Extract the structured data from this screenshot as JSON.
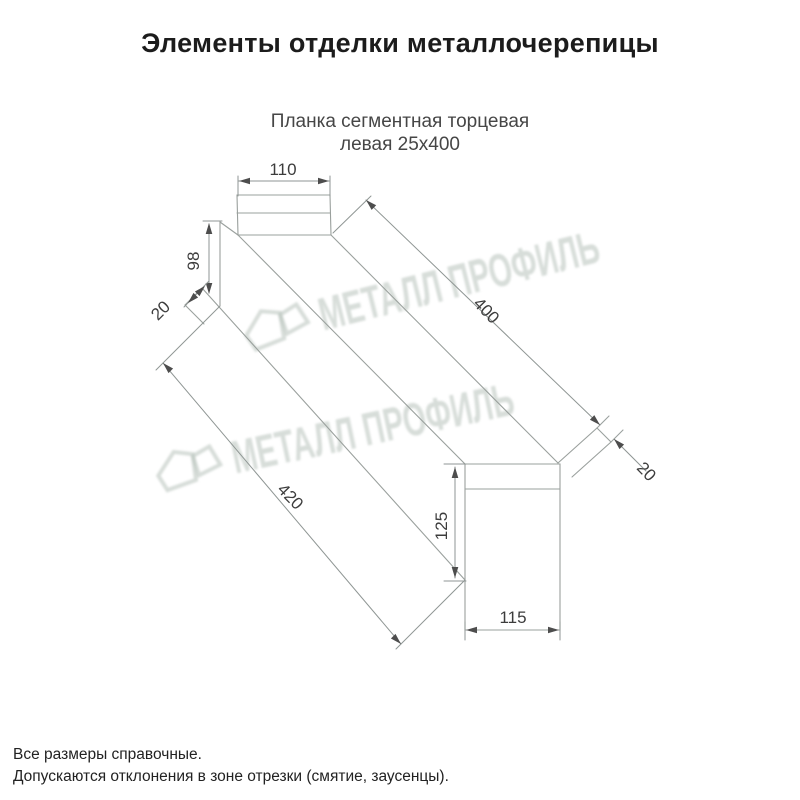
{
  "header": {
    "title": "Элементы отделки металлочерепицы"
  },
  "product": {
    "subtitle_line1": "Планка сегментная торцевая",
    "subtitle_line2": "левая 25х400"
  },
  "drawing": {
    "type": "technical-line-drawing",
    "dimensions": {
      "top_width": "110",
      "end_height": "98",
      "left_fold": "20",
      "top_length": "400",
      "bottom_length": "420",
      "flange_height": "125",
      "flange_width": "115",
      "right_fold": "20"
    },
    "line_color": "#9aa09d",
    "arrow_color": "#4d4d4d",
    "label_color": "#3c3c3c"
  },
  "watermark": {
    "text": "МЕТАЛЛ ПРОФИЛЬ",
    "color": "#b7c1ba"
  },
  "footnotes": {
    "line1": "Все размеры справочные.",
    "line2": "Допускаются отклонения в зоне отрезки (смятие, заусенцы)."
  }
}
